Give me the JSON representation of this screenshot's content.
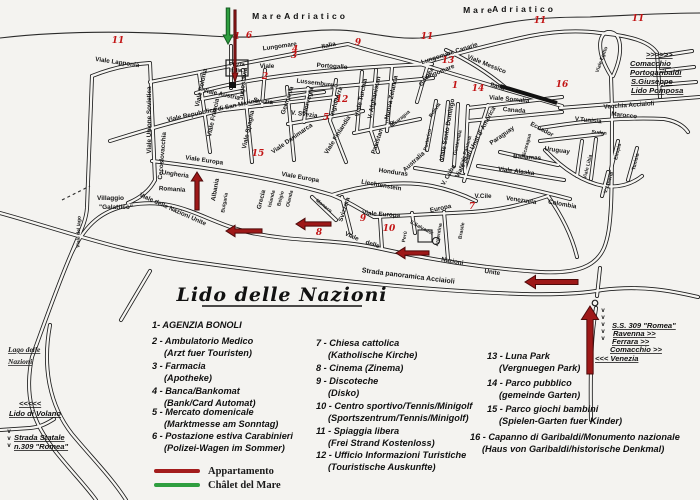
{
  "title": "Lido delle Nazioni",
  "map": {
    "sea_labels": [
      {
        "t": "Mare",
        "x": 268,
        "y": 19
      },
      {
        "t": "Adriatico",
        "x": 316,
        "y": 19
      },
      {
        "t": "Mare",
        "x": 479,
        "y": 13
      },
      {
        "t": "Adriatico",
        "x": 524,
        "y": 12
      }
    ],
    "street_labels": [
      {
        "t": "Viale Lapponia",
        "x": 117,
        "y": 64,
        "r": 8
      },
      {
        "t": "Viale Unione Sovietica",
        "x": 151,
        "y": 120,
        "r": -90
      },
      {
        "t": "Viale Polonia",
        "x": 203,
        "y": 88,
        "r": -78
      },
      {
        "t": "Viale Austria",
        "x": 221,
        "y": 96,
        "r": 12
      },
      {
        "t": "Jugoslavia",
        "x": 245,
        "y": 84,
        "r": -82
      },
      {
        "t": "Piazza",
        "x": 237,
        "y": 66,
        "s": 5
      },
      {
        "t": "Italia",
        "x": 236,
        "y": 72,
        "s": 5
      },
      {
        "t": "Viale",
        "x": 267,
        "y": 68
      },
      {
        "t": "Portogallo",
        "x": 332,
        "y": 68,
        "r": 4
      },
      {
        "t": "Lussemburgo",
        "x": 317,
        "y": 85,
        "r": 7
      },
      {
        "t": "Svezia",
        "x": 263,
        "y": 103,
        "r": 7
      },
      {
        "t": "Germania",
        "x": 289,
        "y": 101,
        "r": -72
      },
      {
        "t": "V. Svezia",
        "x": 304,
        "y": 116,
        "r": 7
      },
      {
        "t": "Norvegia",
        "x": 310,
        "y": 101,
        "r": -75
      },
      {
        "t": "Inghilterra",
        "x": 338,
        "y": 102,
        "r": -72
      },
      {
        "t": "Viale Francia",
        "x": 215,
        "y": 118,
        "r": -78
      },
      {
        "t": "Viale Repubblica di San Marino",
        "x": 213,
        "y": 112,
        "r": -12
      },
      {
        "t": "Viale Spagna",
        "x": 250,
        "y": 130,
        "r": -78
      },
      {
        "t": "Viale Danimarca",
        "x": 293,
        "y": 140,
        "r": -35
      },
      {
        "t": "Viale Finlandia",
        "x": 339,
        "y": 136,
        "r": -58
      },
      {
        "t": "Viale Turchia",
        "x": 363,
        "y": 98,
        "r": -78
      },
      {
        "t": "V. Afghanistan",
        "x": 376,
        "y": 98,
        "r": -78
      },
      {
        "t": "Nuova Zelanda",
        "x": 393,
        "y": 98,
        "r": -78
      },
      {
        "t": "Guinea",
        "x": 428,
        "y": 78,
        "r": -55
      },
      {
        "t": "Nicaragua",
        "x": 401,
        "y": 120,
        "r": -40,
        "s": 5
      },
      {
        "t": "Figi",
        "x": 390,
        "y": 124,
        "s": 5
      },
      {
        "t": "Pakistan",
        "x": 379,
        "y": 142,
        "r": -72
      },
      {
        "t": "Lungomare",
        "x": 280,
        "y": 48,
        "r": -8
      },
      {
        "t": "Italia",
        "x": 329,
        "y": 47,
        "r": -12
      },
      {
        "t": "Lungomare Canarie",
        "x": 450,
        "y": 55,
        "r": -18
      },
      {
        "t": "Lungomare",
        "x": 439,
        "y": 74,
        "r": -22
      },
      {
        "t": "Viale Messico",
        "x": 486,
        "y": 66,
        "r": 22
      },
      {
        "t": "Italia",
        "x": 497,
        "y": 88,
        "r": 16
      },
      {
        "t": "Viale Europa",
        "x": 204,
        "y": 162,
        "r": 8
      },
      {
        "t": "Viale Europa",
        "x": 300,
        "y": 179,
        "r": 10
      },
      {
        "t": "Cecoslovacchia",
        "x": 164,
        "y": 156,
        "r": -85
      },
      {
        "t": "Ungheria",
        "x": 175,
        "y": 176,
        "r": 8
      },
      {
        "t": "Romania",
        "x": 172,
        "y": 191,
        "r": 4
      },
      {
        "t": "Albania",
        "x": 217,
        "y": 190,
        "r": -80
      },
      {
        "t": "Bulgaria",
        "x": 226,
        "y": 203,
        "r": -80,
        "s": 5
      },
      {
        "t": "Grecia",
        "x": 263,
        "y": 200,
        "r": -76
      },
      {
        "t": "Islanda",
        "x": 273,
        "y": 199,
        "r": -76,
        "s": 5
      },
      {
        "t": "Belgio",
        "x": 282,
        "y": 199,
        "r": -76,
        "s": 5
      },
      {
        "t": "Olanda",
        "x": 291,
        "y": 199,
        "r": -76,
        "s": 5
      },
      {
        "t": "Viale delle Nazioni Unite",
        "x": 172,
        "y": 211,
        "r": 24
      },
      {
        "t": "Liechtenstein",
        "x": 381,
        "y": 187,
        "r": 10
      },
      {
        "t": "Monaco",
        "x": 323,
        "y": 207,
        "r": 38,
        "s": 5
      },
      {
        "t": "Svizzera",
        "x": 346,
        "y": 210,
        "r": -72
      },
      {
        "t": "Viale Europa",
        "x": 381,
        "y": 216,
        "r": 4
      },
      {
        "t": "Europa",
        "x": 441,
        "y": 210,
        "r": -12
      },
      {
        "t": "Viale",
        "x": 351,
        "y": 238,
        "r": 24
      },
      {
        "t": "delle",
        "x": 372,
        "y": 246,
        "r": 18
      },
      {
        "t": "Nazioni",
        "x": 452,
        "y": 263,
        "r": 10
      },
      {
        "t": "Unite",
        "x": 492,
        "y": 274,
        "r": 8
      },
      {
        "t": "Strada panoramica Acciaioli",
        "x": 408,
        "y": 278,
        "r": 7,
        "s": 7
      },
      {
        "t": "Honduras",
        "x": 393,
        "y": 174,
        "r": 8
      },
      {
        "t": "Australia",
        "x": 415,
        "y": 163,
        "r": -42
      },
      {
        "t": "V. Cuba",
        "x": 450,
        "y": 176,
        "r": -60
      },
      {
        "t": "Perù",
        "x": 406,
        "y": 237,
        "r": -80,
        "s": 5
      },
      {
        "t": "S.Salvador",
        "x": 421,
        "y": 229,
        "r": 28,
        "s": 5
      },
      {
        "t": "Argentina",
        "x": 440,
        "y": 235,
        "r": -80,
        "s": 5
      },
      {
        "t": "Brasile",
        "x": 463,
        "y": 231,
        "r": -80,
        "s": 5
      },
      {
        "t": "Bolivia",
        "x": 436,
        "y": 111,
        "r": -55,
        "s": 5
      },
      {
        "t": "Portorico",
        "x": 429,
        "y": 140,
        "r": -78,
        "s": 5
      },
      {
        "t": "Viale Santo Domingo",
        "x": 449,
        "y": 130,
        "r": -80
      },
      {
        "t": "Guatemala",
        "x": 459,
        "y": 143,
        "r": -78,
        "s": 5
      },
      {
        "t": "Viale Panama",
        "x": 467,
        "y": 152,
        "r": -74,
        "s": 5
      },
      {
        "t": "Viale Stati Uniti d' America",
        "x": 477,
        "y": 143,
        "r": -62
      },
      {
        "t": "Paraguay",
        "x": 503,
        "y": 137,
        "r": -35
      },
      {
        "t": "Ecuador",
        "x": 541,
        "y": 131,
        "r": 28
      },
      {
        "t": "Nicaragua",
        "x": 528,
        "y": 146,
        "r": -75,
        "s": 5
      },
      {
        "t": "Uruguay",
        "x": 557,
        "y": 152,
        "r": 8
      },
      {
        "t": "Bahamas",
        "x": 527,
        "y": 159,
        "r": 4
      },
      {
        "t": "Viale Alaska",
        "x": 516,
        "y": 173,
        "r": 7
      },
      {
        "t": "V.Cile",
        "x": 483,
        "y": 198
      },
      {
        "t": "Venezuela",
        "x": 521,
        "y": 202,
        "r": 8
      },
      {
        "t": "Colombia",
        "x": 562,
        "y": 206,
        "r": 10
      },
      {
        "t": "Viale Somalia",
        "x": 509,
        "y": 101,
        "r": 5
      },
      {
        "t": "Canada",
        "x": 514,
        "y": 112,
        "r": 5
      },
      {
        "t": "V.Tunisia",
        "x": 588,
        "y": 122,
        "r": 6
      },
      {
        "t": "Marocco",
        "x": 624,
        "y": 117,
        "r": 6
      },
      {
        "t": "Sudan",
        "x": 599,
        "y": 134,
        "r": 6,
        "s": 5
      },
      {
        "t": "Etiopia",
        "x": 619,
        "y": 152,
        "r": -76,
        "s": 5
      },
      {
        "t": "Tunisia",
        "x": 637,
        "y": 162,
        "r": -76,
        "s": 5
      },
      {
        "t": "Viale Libia",
        "x": 589,
        "y": 167,
        "r": -76,
        "s": 5
      },
      {
        "t": "V. Liberia",
        "x": 610,
        "y": 183,
        "r": -72,
        "s": 5
      },
      {
        "t": "Vecchia Acciaioli",
        "x": 629,
        "y": 107,
        "r": -4
      },
      {
        "t": "Viale Egitto",
        "x": 603,
        "y": 60,
        "r": -70,
        "s": 5
      },
      {
        "t": "Villaggio",
        "x": 97,
        "y": 200,
        "an": "s",
        "s": 6.5
      },
      {
        "t": "\"Galattico\"",
        "x": 99,
        "y": 209,
        "an": "s",
        "s": 6.5
      },
      {
        "t": "Viale del lago",
        "x": 80,
        "y": 232,
        "r": -88,
        "s": 5
      }
    ],
    "signs": [
      {
        "t": ">>>>>>",
        "x": 646,
        "y": 57,
        "st": "dir"
      },
      {
        "t": "Comacchio",
        "x": 630,
        "y": 66,
        "st": "dir"
      },
      {
        "t": "Portogaribaldi",
        "x": 630,
        "y": 75,
        "st": "dir"
      },
      {
        "t": "S.Giuseppe",
        "x": 631,
        "y": 84,
        "st": "dir"
      },
      {
        "t": "Lido Pomposa",
        "x": 631,
        "y": 93,
        "st": "dir"
      },
      {
        "t": "S.S. 309 \"Romea\"",
        "x": 612,
        "y": 328,
        "st": "dir"
      },
      {
        "t": "Ravenna >>",
        "x": 613,
        "y": 336,
        "st": "dir"
      },
      {
        "t": "Ferrara >>",
        "x": 612,
        "y": 344,
        "st": "dir"
      },
      {
        "t": "Comacchio >>",
        "x": 610,
        "y": 352,
        "st": "dir"
      },
      {
        "t": "<<< Venezia",
        "x": 595,
        "y": 361,
        "st": "dir"
      },
      {
        "t": "Lago delle",
        "x": 8,
        "y": 352,
        "st": "lake"
      },
      {
        "t": "Nazioni",
        "x": 8,
        "y": 364,
        "st": "lake"
      },
      {
        "t": "<<<<<",
        "x": 19,
        "y": 406,
        "st": "dir"
      },
      {
        "t": "Lido di Volano",
        "x": 9,
        "y": 416,
        "st": "dir"
      },
      {
        "t": "Strada Statale",
        "x": 14,
        "y": 440,
        "st": "dir"
      },
      {
        "t": "n.309  \"Romea\"",
        "x": 14,
        "y": 449,
        "st": "dir"
      }
    ],
    "location_numbers": [
      {
        "n": "11",
        "x": 118,
        "y": 43
      },
      {
        "n": "1",
        "x": 237,
        "y": 39
      },
      {
        "n": "6",
        "x": 249,
        "y": 38
      },
      {
        "n": "4",
        "x": 295,
        "y": 52
      },
      {
        "n": "3",
        "x": 294,
        "y": 58
      },
      {
        "n": "2",
        "x": 265,
        "y": 79
      },
      {
        "n": "9",
        "x": 358,
        "y": 45
      },
      {
        "n": "11",
        "x": 427,
        "y": 39
      },
      {
        "n": "11",
        "x": 540,
        "y": 23
      },
      {
        "n": "11",
        "x": 638,
        "y": 21
      },
      {
        "n": "13",
        "x": 448,
        "y": 63
      },
      {
        "n": "1",
        "x": 455,
        "y": 88
      },
      {
        "n": "14",
        "x": 478,
        "y": 91
      },
      {
        "n": "16",
        "x": 562,
        "y": 87
      },
      {
        "n": "12",
        "x": 342,
        "y": 102
      },
      {
        "n": "5",
        "x": 326,
        "y": 120
      },
      {
        "n": "15",
        "x": 258,
        "y": 156
      },
      {
        "n": "9",
        "x": 363,
        "y": 221
      },
      {
        "n": "10",
        "x": 389,
        "y": 231
      },
      {
        "n": "8",
        "x": 319,
        "y": 235
      },
      {
        "n": "7",
        "x": 472,
        "y": 209
      }
    ],
    "arrows": [
      {
        "dir": "down",
        "color": "#2f9e3f",
        "edge": "#145c22",
        "x": 228,
        "y1": 8,
        "y2": 44,
        "w": 5,
        "name": "chalet-del-mare-arrow"
      },
      {
        "dir": "down",
        "color": "#9e1818",
        "edge": "#4d0a0a",
        "x": 235,
        "y1": 10,
        "y2": 82,
        "w": 3,
        "name": "appartamento-arrow"
      },
      {
        "dir": "up",
        "color": "#9e1818",
        "edge": "#4d0a0a",
        "x": 197,
        "y1": 210,
        "y2": 172,
        "w": 6,
        "name": "route-arrow"
      },
      {
        "dir": "left",
        "color": "#9e1818",
        "edge": "#4d0a0a",
        "x1": 262,
        "x2": 226,
        "y": 231,
        "w": 6,
        "name": "route-arrow"
      },
      {
        "dir": "left",
        "color": "#9e1818",
        "edge": "#4d0a0a",
        "x1": 331,
        "x2": 296,
        "y": 224,
        "w": 6,
        "name": "route-arrow"
      },
      {
        "dir": "left",
        "color": "#9e1818",
        "edge": "#4d0a0a",
        "x1": 429,
        "x2": 396,
        "y": 253,
        "w": 6,
        "name": "route-arrow"
      },
      {
        "dir": "left",
        "color": "#9e1818",
        "edge": "#4d0a0a",
        "x1": 578,
        "x2": 525,
        "y": 282,
        "w": 7,
        "name": "route-arrow"
      },
      {
        "dir": "up",
        "color": "#9e1818",
        "edge": "#4d0a0a",
        "x": 590,
        "y1": 374,
        "y2": 306,
        "w": 9,
        "name": "ss309-arrow"
      }
    ],
    "v_marks": [
      {
        "x": 603,
        "y": 312,
        "n": 5
      },
      {
        "x": 9,
        "y": 433,
        "n": 3
      }
    ]
  },
  "legend": {
    "columns": [
      {
        "x": 152,
        "items": [
          {
            "main": "1- AGENZIA BONOLI",
            "y": 328
          },
          {
            "main": "2 - Ambulatorio Medico",
            "sub": "(Arzt fuer Touristen)",
            "y": 344,
            "ysub": 356
          },
          {
            "main": "3 - Farmacia",
            "sub": "(Apotheke)",
            "y": 369,
            "ysub": 381
          },
          {
            "main": "4 - Banca/Bankomat",
            "sub": "(Bank/Card Automat)",
            "y": 394,
            "ysub": 406
          },
          {
            "main": "5 - Mercato domenicale",
            "sub": "(Marktmesse am Sonntag)",
            "y": 415,
            "ysub": 427
          },
          {
            "main": "6 - Postazione estiva Carabinieri",
            "sub": "(Polizei-Wagen im Sommer)",
            "y": 439,
            "ysub": 451
          }
        ]
      },
      {
        "x": 316,
        "items": [
          {
            "main": "7 - Chiesa cattolica",
            "sub": "(Katholische Kirche)",
            "y": 346,
            "ysub": 358
          },
          {
            "main": "8 - Cinema  (Zinema)",
            "y": 371
          },
          {
            "main": "9 - Discoteche",
            "sub": "(Disko)",
            "y": 384,
            "ysub": 396
          },
          {
            "main": "10 - Centro sportivo/Tennis/Minigolf",
            "sub": "(Sportszentrum/Tennis/Minigolf)",
            "y": 409,
            "ysub": 421
          },
          {
            "main": "11 - Spiaggia libera",
            "sub": "(Frei Strand Kostenloss)",
            "y": 434,
            "ysub": 446
          },
          {
            "main": "12 - Ufficio Informazioni Turistiche",
            "sub": "(Touristische Auskunfte)",
            "y": 458,
            "ysub": 470
          }
        ]
      },
      {
        "x": 487,
        "items": [
          {
            "main": "13 - Luna Park",
            "sub": "(Vergnuegen Park)",
            "y": 359,
            "ysub": 371
          },
          {
            "main": "14 - Parco pubblico",
            "sub": "(gemeinde Garten)",
            "y": 386,
            "ysub": 398
          },
          {
            "main": "15 - Parco giochi bambini",
            "sub": "(Spielen-Garten fuer Kinder)",
            "y": 412,
            "ysub": 424
          },
          {
            "main": "16 - Capanno di Garibaldi/Monumento nazionale",
            "sub": "(Haus von Garibaldi/historische Denkmal)",
            "y": 440,
            "ysub": 452,
            "x": 470
          }
        ]
      }
    ],
    "key": [
      {
        "color": "#a31c1c",
        "label": "Appartamento",
        "y": 471
      },
      {
        "color": "#2f9e3f",
        "label": "Châlet del Mare",
        "y": 485
      }
    ]
  }
}
